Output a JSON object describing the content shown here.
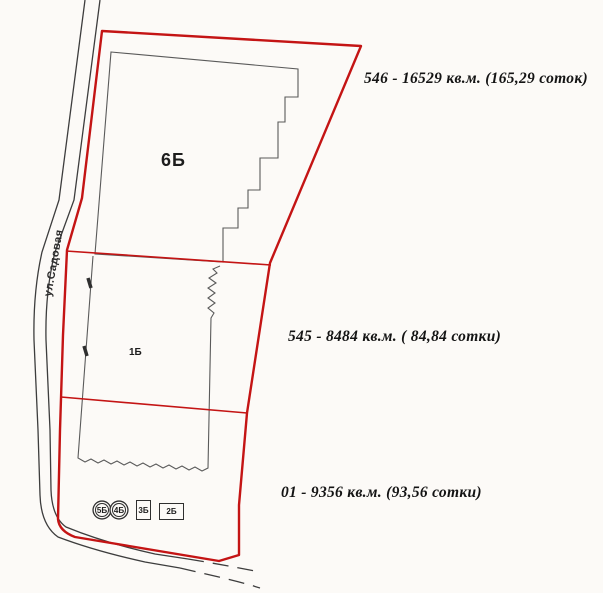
{
  "colors": {
    "boundary": "#c41414",
    "ink": "#3d3d3d",
    "outline": "#5a5a5a",
    "paper": "#fcfaf7",
    "label": "#141414",
    "hatch_line": "#c3bfc2"
  },
  "street_label": "ул.Садовая",
  "area_labels": {
    "p546": "546 - 16529 кв.м. (165,29 соток)",
    "p545": "545 - 8484 кв.м. ( 84,84 сотки)",
    "p01": "01 - 9356 кв.м. (93,56 сотки)"
  },
  "building_labels": {
    "b6": "6Б",
    "b1": "1Б",
    "b5": "5Б",
    "b4": "4Б",
    "b3": "3Б",
    "b2": "2Б"
  }
}
